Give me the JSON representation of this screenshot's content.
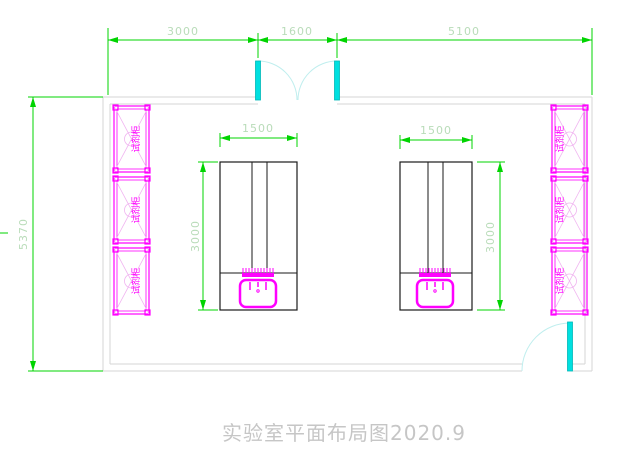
{
  "title": {
    "text": "实验室平面布局图2020.9"
  },
  "dimensions": {
    "top": [
      {
        "label": "3000"
      },
      {
        "label": "1600"
      },
      {
        "label": "5100"
      }
    ],
    "overall_height": "5370",
    "left_bench": {
      "width": "1500",
      "height": "3000"
    },
    "right_bench": {
      "width": "1500",
      "height": "3000"
    }
  },
  "cabinets": {
    "left": [
      "试剂柜",
      "试剂柜",
      "试剂柜"
    ],
    "right": [
      "试剂柜",
      "试剂柜",
      "试剂柜"
    ]
  },
  "colors": {
    "dimension": "#00d400",
    "dimension_text": "#b9dcb9",
    "cabinet": "#ff00ff",
    "cabinet_light": "#f0b4f0",
    "door": "#00e0e0",
    "door_arc": "#bfeeee",
    "wall": "#d6d6d6",
    "bench": "#1a1a1a",
    "title_text": "#c6c6c6"
  }
}
